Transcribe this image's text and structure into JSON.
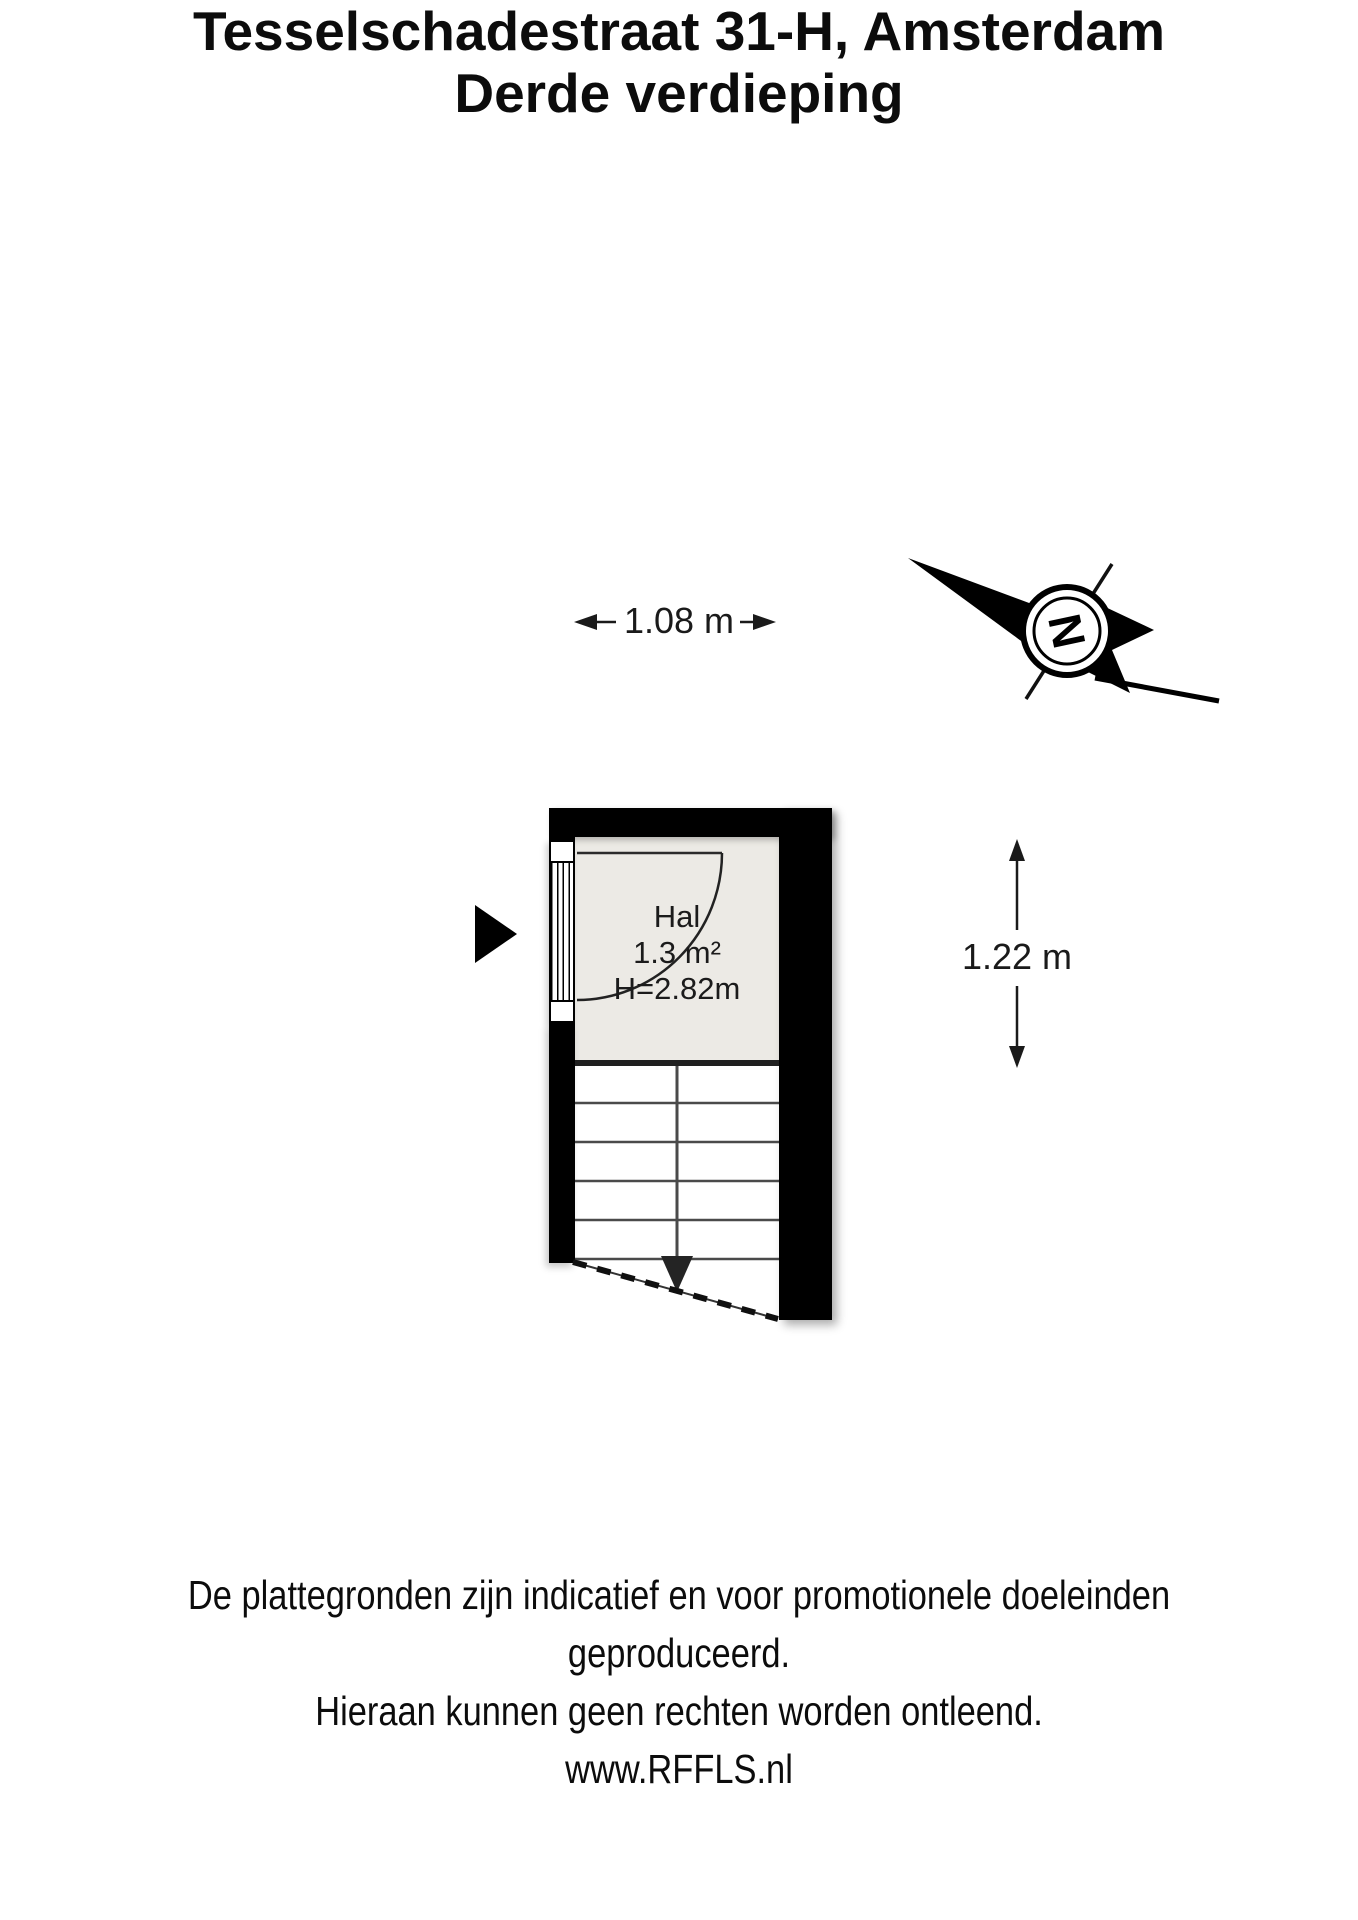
{
  "title": {
    "line1": "Tesselschadestraat 31-H, Amsterdam",
    "line2": "Derde verdieping"
  },
  "compass": {
    "north_label": "N"
  },
  "dimensions": {
    "width_label": "1.08 m",
    "height_label": "1.22 m"
  },
  "floorplan": {
    "room": {
      "name": "Hal",
      "area": "1.3 m²",
      "ceiling_height": "H=2.82m"
    },
    "colors": {
      "wall": "#000000",
      "floor": "#ECEAE5",
      "background": "#FFFFFF"
    }
  },
  "footer": {
    "lines": [
      "De plattegronden zijn indicatief en voor promotionele doeleinden geproduceerd.",
      "Hieraan kunnen geen rechten worden ontleend.",
      "www.RFFLS.nl"
    ]
  }
}
